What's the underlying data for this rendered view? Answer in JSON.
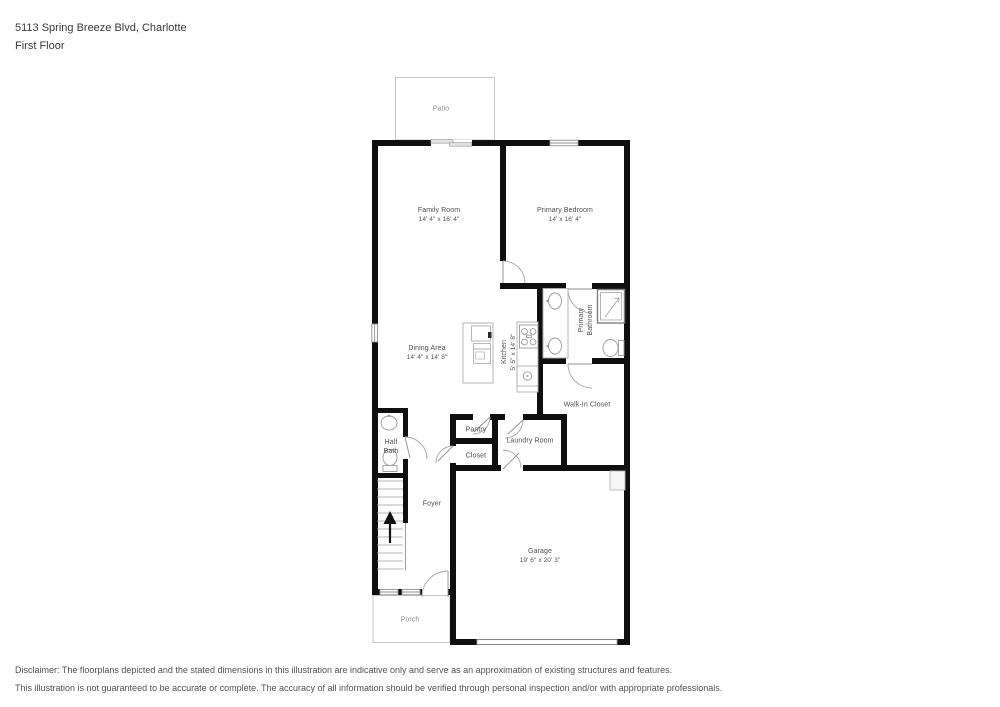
{
  "header": {
    "address_line": "5113 Spring Breeze Blvd, Charlotte",
    "floor_line": "First Floor"
  },
  "rooms": {
    "patio": {
      "name": "Patio"
    },
    "family_room": {
      "name": "Family Room",
      "dims": "14' 4\" x 16' 4\""
    },
    "primary_bedroom": {
      "name": "Primary Bedroom",
      "dims": "14' x 16' 4\""
    },
    "dining_area": {
      "name": "Dining Area",
      "dims": "14' 4\" x 14' 8\""
    },
    "kitchen": {
      "name": "Kitchen",
      "dims": "5' 5\" x 14' 8\""
    },
    "primary_bathroom": {
      "name": "Primary Bathroom"
    },
    "walk_in_closet": {
      "name": "Walk-In Closet"
    },
    "half_bath": {
      "name": "Half Bath"
    },
    "pantry": {
      "name": "Pantry"
    },
    "closet": {
      "name": "Closet"
    },
    "laundry_room": {
      "name": "Laundry Room"
    },
    "foyer": {
      "name": "Foyer"
    },
    "garage": {
      "name": "Garage",
      "dims": "19' 6\" x 20' 3\""
    },
    "porch": {
      "name": "Porch"
    }
  },
  "disclaimer": {
    "line1": "Disclaimer: The floorplans depicted and the stated dimensions in this illustration are indicative only and serve as an approximation of existing structures and features.",
    "line2": "This illustration is not guaranteed to be accurate or complete. The accuracy of all information should be verified through personal inspection and/or with appropriate professionals."
  },
  "colors": {
    "wall": "#0f0f0f",
    "fixture_outline": "#a6a6a6",
    "outdoor_outline": "#c6c6c6",
    "label_text": "#4f4f4f"
  }
}
